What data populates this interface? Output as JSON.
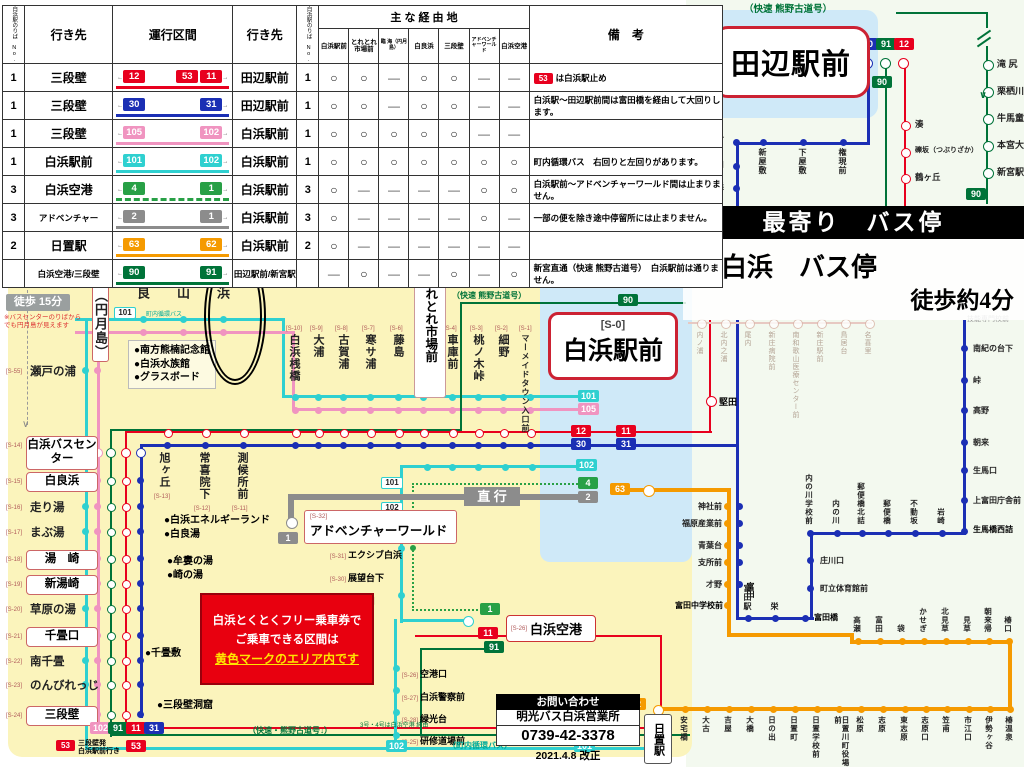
{
  "colors": {
    "cyan": "#2fd0d0",
    "pink": "#f094c0",
    "red": "#e8001e",
    "blue": "#1b2fb4",
    "green": "#28a046",
    "dkgreen": "#007339",
    "gray": "#8c8c8c",
    "orange": "#f59a00",
    "yellow_bg": "#fbf4bc",
    "lightblue": "#cfe9f8",
    "right_bg": "#f3f9ef",
    "warning": "#e60012"
  },
  "routes": {
    "r12": {
      "label": "12",
      "color": "#e8001e"
    },
    "r11": {
      "label": "11",
      "color": "#e8001e"
    },
    "r53": {
      "label": "53",
      "color": "#e8001e"
    },
    "r30": {
      "label": "30",
      "color": "#1b2fb4"
    },
    "r31": {
      "label": "31",
      "color": "#1b2fb4"
    },
    "r105": {
      "label": "105",
      "color": "#f094c0"
    },
    "r102p": {
      "label": "102",
      "color": "#f094c0"
    },
    "r101": {
      "label": "101",
      "color": "#2fd0d0"
    },
    "r102c": {
      "label": "102",
      "color": "#2fd0d0"
    },
    "r4": {
      "label": "4",
      "color": "#28a046"
    },
    "r1g": {
      "label": "1",
      "color": "#28a046"
    },
    "r2": {
      "label": "2",
      "color": "#8c8c8c"
    },
    "r1x": {
      "label": "1",
      "color": "#8c8c8c"
    },
    "r63": {
      "label": "63",
      "color": "#f59a00"
    },
    "r62": {
      "label": "62",
      "color": "#f59a00"
    },
    "r90": {
      "label": "90",
      "color": "#007339"
    },
    "r91": {
      "label": "91",
      "color": "#007339"
    }
  },
  "table": {
    "platform_header": "白浜駅のりば No.",
    "dest_header": "行き先",
    "section_header": "運行区間",
    "via_header": "主 な 経 由 地",
    "remarks_header": "備　考",
    "arrow_left": "←",
    "arrow_right": "→",
    "via_columns": [
      "白浜駅前",
      "とれとれ市場前",
      "臨 海（円月島）",
      "白良浜",
      "三段壁",
      "アドベンチャーワールド",
      "白浜空港"
    ],
    "rows": [
      {
        "no": "1",
        "dest": "三段壁",
        "left": [
          "r12"
        ],
        "right": [
          "r53",
          "r11"
        ],
        "line": "#e8001e",
        "dest2": "田辺駅前",
        "no2": "1",
        "via": [
          "○",
          "○",
          "—",
          "○",
          "○",
          "—",
          "—"
        ],
        "remark": "は白浜駅止め",
        "remark_badge": "r53"
      },
      {
        "no": "1",
        "dest": "三段壁",
        "left": [
          "r30"
        ],
        "right": [
          "r31"
        ],
        "line": "#1b2fb4",
        "dest2": "田辺駅前",
        "no2": "1",
        "via": [
          "○",
          "○",
          "—",
          "○",
          "○",
          "—",
          "—"
        ],
        "remark": "白浜駅〜田辺駅前間は富田橋を経由して大回りします。"
      },
      {
        "no": "1",
        "dest": "三段壁",
        "left": [
          "r105"
        ],
        "right": [
          "r102p"
        ],
        "line": "#f094c0",
        "dest2": "白浜駅前",
        "no2": "1",
        "via": [
          "○",
          "○",
          "○",
          "○",
          "○",
          "—",
          "—"
        ],
        "remark": ""
      },
      {
        "no": "1",
        "dest": "白浜駅前",
        "left": [
          "r101"
        ],
        "right": [
          "r102c"
        ],
        "line": "#2fd0d0",
        "dest2": "白浜駅前",
        "no2": "1",
        "via": [
          "○",
          "○",
          "○",
          "○",
          "○",
          "○",
          "○"
        ],
        "remark": "町内循環バス　右回りと左回りがあります。"
      },
      {
        "no": "3",
        "dest": "白浜空港",
        "left": [
          "r4"
        ],
        "right": [
          "r1g"
        ],
        "line": "#28a046",
        "dashed": true,
        "dest2": "白浜駅前",
        "no2": "3",
        "via": [
          "○",
          "—",
          "—",
          "—",
          "—",
          "○",
          "○"
        ],
        "remark": "白浜駅前〜アドベンチャーワールド間は止まりません。"
      },
      {
        "no": "3",
        "dest": "アドベンチャー",
        "left": [
          "r2"
        ],
        "right": [
          "r1x"
        ],
        "line": "#8c8c8c",
        "dest2": "白浜駅前",
        "no2": "3",
        "via": [
          "○",
          "—",
          "—",
          "—",
          "—",
          "○",
          "—"
        ],
        "remark": "一部の便を除き途中停留所には止まりません。"
      },
      {
        "no": "2",
        "dest": "日置駅",
        "left": [
          "r63"
        ],
        "right": [
          "r62"
        ],
        "line": "#f59a00",
        "dest2": "白浜駅前",
        "no2": "2",
        "via": [
          "○",
          "—",
          "—",
          "—",
          "—",
          "—",
          "—"
        ],
        "remark": ""
      },
      {
        "no": "",
        "dest": "白浜空港/三段壁",
        "left": [
          "r90"
        ],
        "right": [
          "r91"
        ],
        "line": "#007339",
        "dest2": "田辺駅前/新宮駅",
        "no2": "",
        "via": [
          "—",
          "○",
          "—",
          "—",
          "○",
          "—",
          "○"
        ],
        "remark": "新宮直通（快速 熊野古道号）　白浜駅前は通りません。"
      }
    ]
  },
  "banner": {
    "title": "最寄り　バス停",
    "stop_name": "東白浜　バス停",
    "walk": "徒歩約4分"
  },
  "contact": {
    "header": "お問い合わせ",
    "office": "明光バス白浜営業所",
    "tel": "0739-42-3378",
    "revision": "2021.4.8 改正"
  },
  "left_map": {
    "legend": "この印の停留所は片方向のみ停車します",
    "warning": "運行系統番号は行きと帰りで異なりますのでご注意ください。",
    "walk15": "徒歩 15分",
    "walk15_note": "※バスセンターのりばからでも円月島が見えます",
    "top_stations": [
      {
        "id": "[S-54]",
        "name": "臨海（円月島）",
        "boxed": true
      },
      {
        "id": "[S-53]",
        "name": "江津良"
      },
      {
        "id": "[S-52]",
        "name": "阪田山"
      },
      {
        "id": "[S-51]",
        "name": "東白浜"
      }
    ],
    "toretore_id": "[S-5]",
    "toretore": "とれとれ市場前",
    "station_id": "[S-0]",
    "station": "白浜駅前",
    "mid_row": [
      {
        "id": "[S-10]",
        "name": "白浜桟橋"
      },
      {
        "id": "[S-9]",
        "name": "大浦"
      },
      {
        "id": "[S-8]",
        "name": "古賀浦"
      },
      {
        "id": "[S-7]",
        "name": "寒サ浦"
      },
      {
        "id": "[S-6]",
        "name": "藤島"
      },
      {
        "id": "[S-4]",
        "name": "車庫前"
      },
      {
        "id": "[S-3]",
        "name": "桃ノ木峠"
      },
      {
        "id": "[S-2]",
        "name": "細野"
      },
      {
        "id": "[S-1]",
        "name": "マーメイドタウン入口前"
      }
    ],
    "left_column": [
      {
        "id": "[S-55]",
        "name": "瀬戸の浦"
      },
      {
        "id": "[S-14]",
        "name": "白浜バスセンター",
        "boxed": true
      },
      {
        "id": "[S-15]",
        "name": "白良浜",
        "boxed": true
      },
      {
        "id": "[S-16]",
        "name": "走り湯"
      },
      {
        "id": "[S-17]",
        "name": "まぶ湯"
      },
      {
        "id": "[S-18]",
        "name": "湯　崎",
        "boxed": true
      },
      {
        "id": "[S-19]",
        "name": "新湯崎",
        "boxed": true
      },
      {
        "id": "[S-20]",
        "name": "草原の湯"
      },
      {
        "id": "[S-21]",
        "name": "千畳口",
        "boxed": true
      },
      {
        "id": "[S-22]",
        "name": "南千畳"
      },
      {
        "id": "[S-23]",
        "name": "のんびれっじ"
      },
      {
        "id": "[S-24]",
        "name": "三段壁",
        "boxed": true
      }
    ],
    "mid_column": [
      {
        "id": "[S-13]",
        "name": "旭ヶ丘"
      },
      {
        "id": "[S-12]",
        "name": "常喜院下"
      },
      {
        "id": "[S-11]",
        "name": "測候所前"
      }
    ],
    "branch_column": [
      {
        "id": "[S-31]",
        "name": "エクシブ白浜"
      },
      {
        "id": "[S-30]",
        "name": "展望台下"
      },
      {
        "id": "[S-29]",
        "name": "空港口"
      }
    ],
    "airport_id": "[S-26]",
    "airport": "白浜空港",
    "airport_column": [
      {
        "id": "[S-26]",
        "name": "空港口"
      },
      {
        "id": "[S-27]",
        "name": "白浜警察前"
      },
      {
        "id": "[S-28]",
        "name": "緑光台"
      },
      {
        "id": "[S-25]",
        "name": "研修道場前"
      }
    ],
    "adventure_id": "[S-32]",
    "adventure": "アドベンチャーワールド",
    "chokko": "直 行",
    "poi1": [
      "南方熊楠記念館",
      "白浜水族館",
      "グラスボード"
    ],
    "poi2": [
      "白浜エネルギーランド",
      "白良湯"
    ],
    "poi3": [
      "牟婁の湯",
      "崎の湯"
    ],
    "poi4": [
      "千畳敷"
    ],
    "poi5": [
      "三段壁洞窟"
    ],
    "free_pass": [
      "白浜とくとくフリー乗車券で",
      "ご乗車できる区間は",
      "黄色マークのエリア内です"
    ],
    "note53": [
      "三段壁発",
      "白浜駅前行き"
    ],
    "kaisoku_mid": "（快速 熊野古道号）",
    "kaisoku_bottom": "（快速・熊野古道号↓）",
    "airport_via_note": "3号・4号は白浜空港 経由",
    "chonai": "（町内循環バス）",
    "chonai_top": "町内循環バス"
  },
  "right_map": {
    "kaisoku_top": "（快速 熊野古道号）",
    "tanabe": "田辺駅前",
    "kumano": [
      "滝 尻",
      "栗栖川",
      "牛馬童子口",
      "本宮大社前",
      "新宮駅"
    ],
    "red_v": [
      "湊",
      "礫坂（つぶりざか）",
      "鶴ヶ丘"
    ],
    "blue_v": [
      "東本町",
      "磯間口",
      "神子浜"
    ],
    "blue_h": [
      "新屋敷",
      "下屋敷",
      "権現前"
    ],
    "faded": [
      "内ノ浦",
      "北内之浦",
      "尾内",
      "新庄病院前",
      "南和歌山医療センター前",
      "新庄駅前",
      "鳥居台",
      "名喜里"
    ],
    "gino": "技能専門校前",
    "katada": "堅田",
    "blue_right": [
      "南紀の台下",
      "峠",
      "高野",
      "朝来",
      "生馬口",
      "上富田庁舎前"
    ],
    "ikuma": "生馬橋西詰",
    "blue_mid": [
      "内の川学校前",
      "内の川",
      "郵便橋北詰",
      "郵便橋",
      "不動坂",
      "岩崎"
    ],
    "blue_down": [
      "庄川口",
      "町立体育館前"
    ],
    "tonda_loop": [
      "富田駅",
      "栄"
    ],
    "tondabashi": "富田橋",
    "orange_v": [
      "神社前",
      "福原産業前",
      "青葉台",
      "支所前",
      "才野"
    ],
    "tonda": "富田",
    "tonda_school": "富田中学校前",
    "orange_row1": [
      "高瀬",
      "富田",
      "袋",
      "かせぎ",
      "北見草",
      "見草",
      "朝来帰",
      "椿口"
    ],
    "orange_row2": [
      "安宅橋",
      "大古",
      "吉屋",
      "大橋",
      "日の出",
      "日置町",
      "日置学校前",
      "日置川町役場前",
      "松原",
      "志原",
      "東志原",
      "志原口",
      "笠甫",
      "市江口",
      "伊勢ヶ谷",
      "椿温泉"
    ],
    "hiki": "日置駅"
  }
}
